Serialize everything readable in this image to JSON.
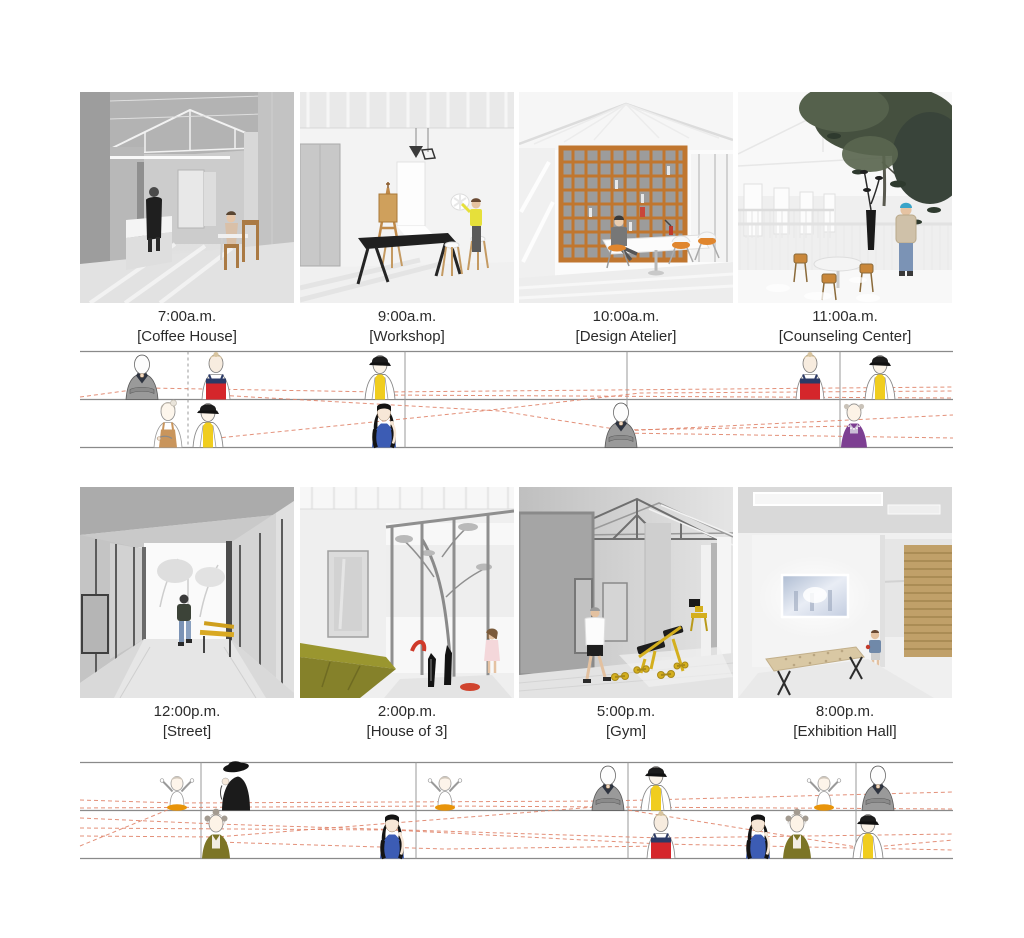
{
  "board": {
    "background": "#ffffff",
    "text_color": "#2b2b2b",
    "timeline_line_color": "#8a8a8a",
    "timeline_dash_color": "#e0846a"
  },
  "colors": {
    "accent_yellow": "#f0cd1f",
    "accent_red": "#d5262b",
    "accent_blue": "#3c5cb4",
    "accent_olive": "#7c7526",
    "accent_purple": "#7d3f92",
    "accent_orange_skirt": "#e8940a",
    "bookshelf_wood": "#c0762f",
    "gym_equipment_yellow": "#d4af1e"
  },
  "panels": [
    {
      "id": "coffee-house",
      "time": "7:00a.m.",
      "name": "[Coffee House]"
    },
    {
      "id": "workshop",
      "time": "9:00a.m.",
      "name": "[Workshop]"
    },
    {
      "id": "design-atelier",
      "time": "10:00a.m.",
      "name": "[Design Atelier]"
    },
    {
      "id": "counseling-center",
      "time": "11:00a.m.",
      "name": "[Counseling Center]"
    },
    {
      "id": "street",
      "time": "12:00p.m.",
      "name": "[Street]"
    },
    {
      "id": "house-of-3",
      "time": "2:00p.m.",
      "name": "[House of 3]"
    },
    {
      "id": "gym",
      "time": "5:00p.m.",
      "name": "[Gym]"
    },
    {
      "id": "exhibition-hall",
      "time": "8:00p.m.",
      "name": "[Exhibition Hall]"
    }
  ],
  "strips": [
    {
      "id": "morning-timeline",
      "top": 351,
      "dividers": [
        {
          "x": 108,
          "style": "dashed"
        },
        {
          "x": 325,
          "style": "solid"
        },
        {
          "x": 547,
          "style": "solid"
        },
        {
          "x": 760,
          "style": "solid"
        }
      ],
      "figures": [
        {
          "variant": "man-in-gray-suit",
          "row": "upper",
          "x": 62
        },
        {
          "variant": "child-red-sailor-top",
          "row": "upper",
          "x": 136
        },
        {
          "variant": "barista-yellow-apron-cap",
          "row": "upper",
          "x": 300
        },
        {
          "variant": "child-red-sailor-top",
          "row": "upper",
          "x": 730
        },
        {
          "variant": "barista-yellow-apron-cap",
          "row": "upper",
          "x": 800
        },
        {
          "variant": "woman-tan-apron",
          "row": "lower",
          "x": 88
        },
        {
          "variant": "barista-yellow-apron-cap",
          "row": "lower",
          "x": 128
        },
        {
          "variant": "woman-long-hair-blue-top",
          "row": "lower",
          "x": 304
        },
        {
          "variant": "man-in-gray-suit",
          "row": "lower",
          "x": 541
        },
        {
          "variant": "elder-woman-purple-top",
          "row": "lower",
          "x": 774
        }
      ],
      "paths": [
        [
          [
            0,
            46
          ],
          [
            67,
            37
          ],
          [
            300,
            41
          ],
          [
            873,
            36
          ]
        ],
        [
          [
            300,
            44
          ],
          [
            873,
            47
          ]
        ],
        [
          [
            136,
            44
          ],
          [
            420,
            60
          ],
          [
            541,
            79
          ],
          [
            774,
            75
          ]
        ],
        [
          [
            128,
            88
          ],
          [
            420,
            58
          ],
          [
            560,
            42
          ],
          [
            873,
            40
          ]
        ],
        [
          [
            541,
            80
          ],
          [
            873,
            64
          ]
        ],
        [
          [
            541,
            82
          ],
          [
            873,
            87
          ]
        ]
      ]
    },
    {
      "id": "evening-timeline",
      "top": 762,
      "dividers": [
        {
          "x": 121,
          "style": "solid"
        },
        {
          "x": 336,
          "style": "solid"
        },
        {
          "x": 548,
          "style": "solid"
        },
        {
          "x": 776,
          "style": "solid"
        }
      ],
      "figures": [
        {
          "variant": "child-arms-raised-orange-skirt",
          "row": "upper",
          "x": 97
        },
        {
          "variant": "person-black-hat-coat",
          "row": "upper",
          "x": 154
        },
        {
          "variant": "child-arms-raised-orange-skirt",
          "row": "upper",
          "x": 365
        },
        {
          "variant": "man-in-gray-suit",
          "row": "upper",
          "x": 528
        },
        {
          "variant": "barista-yellow-apron-cap",
          "row": "upper",
          "x": 576
        },
        {
          "variant": "child-arms-raised-orange-skirt",
          "row": "upper",
          "x": 744
        },
        {
          "variant": "man-in-gray-suit",
          "row": "upper",
          "x": 798
        },
        {
          "variant": "elder-woman-olive-jacket",
          "row": "lower",
          "x": 136
        },
        {
          "variant": "woman-long-hair-blue-top",
          "row": "lower",
          "x": 312
        },
        {
          "variant": "child-red-sailor-top",
          "row": "lower",
          "x": 581
        },
        {
          "variant": "woman-long-hair-blue-top",
          "row": "lower",
          "x": 678
        },
        {
          "variant": "elder-woman-olive-jacket",
          "row": "lower",
          "x": 717
        },
        {
          "variant": "barista-yellow-apron-cap",
          "row": "lower",
          "x": 788
        }
      ],
      "paths": [
        [
          [
            0,
            38
          ],
          [
            97,
            41
          ],
          [
            528,
            39
          ],
          [
            873,
            30
          ]
        ],
        [
          [
            0,
            46
          ],
          [
            365,
            44
          ],
          [
            873,
            47
          ]
        ],
        [
          [
            0,
            56
          ],
          [
            136,
            62
          ],
          [
            581,
            76
          ],
          [
            873,
            72
          ]
        ],
        [
          [
            0,
            66
          ],
          [
            312,
            68
          ],
          [
            581,
            82
          ],
          [
            873,
            88
          ]
        ],
        [
          [
            0,
            74
          ],
          [
            136,
            75
          ],
          [
            528,
            44
          ]
        ],
        [
          [
            548,
            48
          ],
          [
            783,
            86
          ],
          [
            873,
            78
          ]
        ],
        [
          [
            136,
            80
          ],
          [
            365,
            87
          ],
          [
            581,
            84
          ]
        ],
        [
          [
            0,
            84
          ],
          [
            97,
            44
          ]
        ]
      ]
    }
  ]
}
